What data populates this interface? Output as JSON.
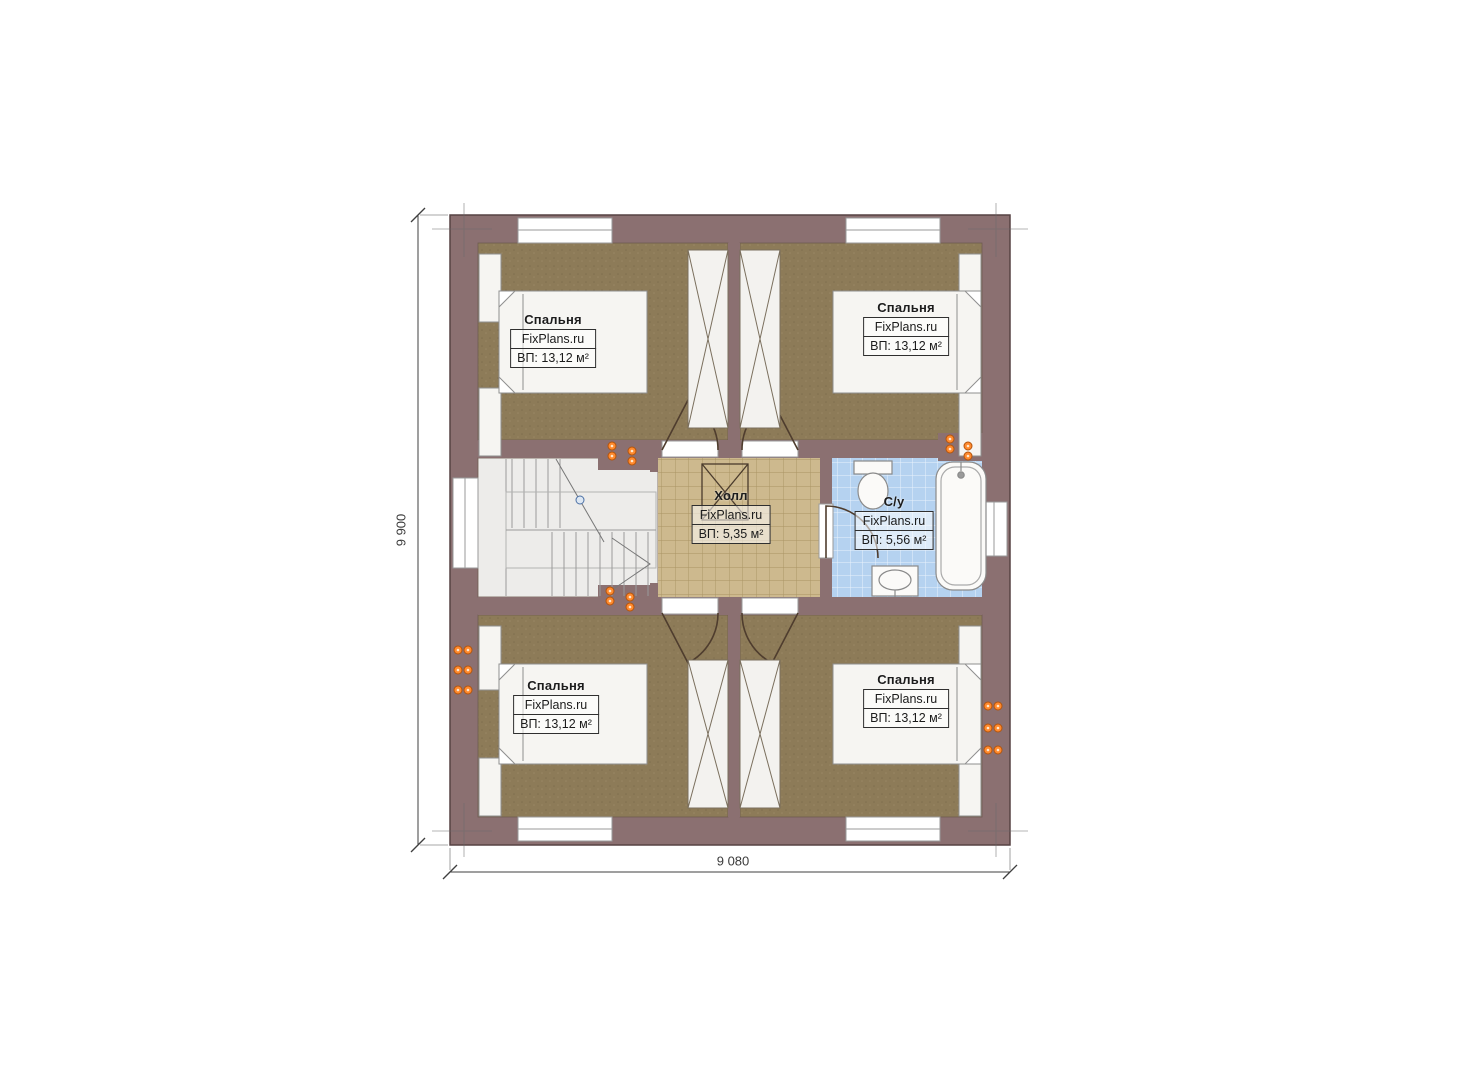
{
  "plan": {
    "rooms": {
      "bedroom_top_left": {
        "name": "Спальня",
        "brand": "FixPlans.ru",
        "area": "ВП: 13,12 м²"
      },
      "bedroom_top_right": {
        "name": "Спальня",
        "brand": "FixPlans.ru",
        "area": "ВП: 13,12 м²"
      },
      "bedroom_bottom_left": {
        "name": "Спальня",
        "brand": "FixPlans.ru",
        "area": "ВП: 13,12 м²"
      },
      "bedroom_bottom_right": {
        "name": "Спальня",
        "brand": "FixPlans.ru",
        "area": "ВП: 13,12 м²"
      },
      "hall": {
        "name": "Холл",
        "brand": "FixPlans.ru",
        "area": "ВП: 5,35 м²"
      },
      "bathroom": {
        "name": "С/у",
        "brand": "FixPlans.ru",
        "area": "ВП: 5,56 м²"
      }
    },
    "dimensions": {
      "overall_height": "9 900",
      "overall_width": "9 080"
    },
    "colors": {
      "wall": "#8b7071",
      "bedroom_floor": "#8d7b58",
      "hall_floor": "#cdb98e",
      "bathroom_floor": "#b5d2f0",
      "stair_floor": "#edecea",
      "fixture_fill": "#f6f5f2",
      "socket_orange": "#ff8a2e"
    }
  }
}
